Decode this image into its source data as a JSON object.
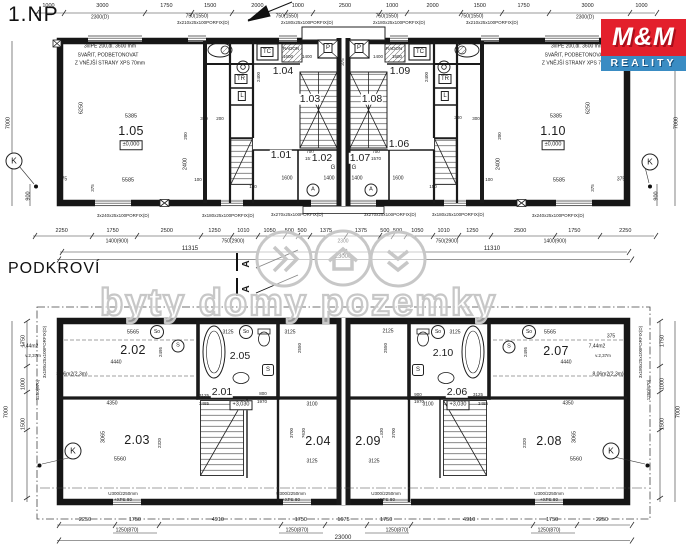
{
  "titles": {
    "floor1": "1.NP",
    "attic": "PODKROVÍ"
  },
  "logo": {
    "top": "M&M",
    "bottom": "REALITY",
    "red": "#e3202c",
    "blue": "#3a8cc3"
  },
  "watermark": {
    "text": "byty domy pozemky"
  },
  "beam_note": {
    "l1": "3xIPE 200,dl. 3600 mm",
    "l2": "SVAŘIT, PODBETONOVAT",
    "l3": "Z VNĚJŠÍ STRANY XPS 70mm"
  },
  "floor1": {
    "dims_top": [
      "1000",
      "3000",
      "1750",
      "1500",
      "2000",
      "1000",
      "2500",
      "1000",
      "2000",
      "1500",
      "1750",
      "3000",
      "1000"
    ],
    "dims_top_sub": [
      "2300(D)",
      "750(1550)",
      "750(1550)",
      "750(1550)",
      "750(1550)",
      "2300(D)"
    ],
    "porfix_top": [
      "3x210x25x100PORFIX(D)",
      "2x180x25x100PORFIX(D)",
      "2x180x25x100PORFIX(D)",
      "3x210x25x100PORFIX(D)"
    ],
    "dims_bottom": [
      "2250",
      "1750",
      "2500",
      "1250",
      "1010",
      "1050",
      "500",
      "500",
      "1375",
      "1375",
      "500",
      "500",
      "1050",
      "1010",
      "1250",
      "2500",
      "1750",
      "2250"
    ],
    "dims_bottom_sub": [
      "1400(900)",
      "750(2900)",
      "2300",
      "750(2900)",
      "1400(900)"
    ],
    "porfix_bottom": [
      "3x240x25x100PORFIX(D)",
      "3x180x25x100PORFIX(D)",
      "3x270x25x100PORFIX(D)",
      "3x270x25x100PORFIX(D)",
      "3x180x25x100PORFIX(D)",
      "3x240x25x100PORFIX(D)"
    ],
    "rooms": {
      "r101": "1.01",
      "r102": "1.02",
      "r103": "1.03",
      "r104": "1.04",
      "r105": "1.05",
      "r106": "1.06",
      "r107": "1.07",
      "r108": "1.08",
      "r109": "1.09",
      "r110": "1.10"
    },
    "level": "±0,000",
    "cells": {
      "tc": "TČ",
      "tr": "TR",
      "l": "L",
      "p": "P",
      "radon": "RADON"
    },
    "marks": {
      "k": "K",
      "a": "A",
      "g": "G"
    },
    "in": {
      "i6250": "6250",
      "i5385": "5385",
      "i5585": "5585",
      "i2400": "2400",
      "i375": "375",
      "i100": "100",
      "i300": "300",
      "i200": "200",
      "i150": "150",
      "i700": "700",
      "i1570": "1570",
      "i1600": "1600",
      "i1400": "1400",
      "i7000": "7000",
      "i900": "900",
      "i11315": "11315",
      "i11310": "11310",
      "i23000": "23000"
    }
  },
  "attic": {
    "rooms": {
      "r201": "2.01",
      "r202": "2.02",
      "r203": "2.03",
      "r204": "2.04",
      "r205": "2.05",
      "r206": "2.06",
      "r207": "2.07",
      "r208": "2.08",
      "r209": "2.09",
      "r210": "2.10"
    },
    "level": "+3,030",
    "area_a": "7,44m2",
    "height_a": "v.2,37m",
    "area_b": "8,06m2(2,3m)",
    "u300": "U300/2250mm",
    "xps": "+XPS 80",
    "porfix_side": "3x180x25x100PORFIX(D)",
    "dims_bottom": [
      "2250",
      "1750",
      "4910",
      "1750",
      "1675",
      "1750",
      "4910",
      "1750",
      "2250"
    ],
    "sub": "1250(870)",
    "marks": {
      "k": "K",
      "s": "S",
      "so": "So"
    },
    "in": {
      "i5565": "5565",
      "i4440": "4440",
      "i4350": "4350",
      "i5560": "5560",
      "i3065": "3065",
      "i2320": "2320",
      "i3125": "3125",
      "i3485": "3485",
      "i3100": "3100",
      "i3700": "3700",
      "i3630": "3630",
      "i2125": "2125",
      "i2550": "2550",
      "i2495": "2495",
      "i800": "800",
      "i900": "900",
      "i1970": "1970",
      "i375": "375",
      "i1750": "1750",
      "i1000": "1000",
      "i1500": "1500",
      "i7000": "7000",
      "i23000": "23000"
    }
  }
}
